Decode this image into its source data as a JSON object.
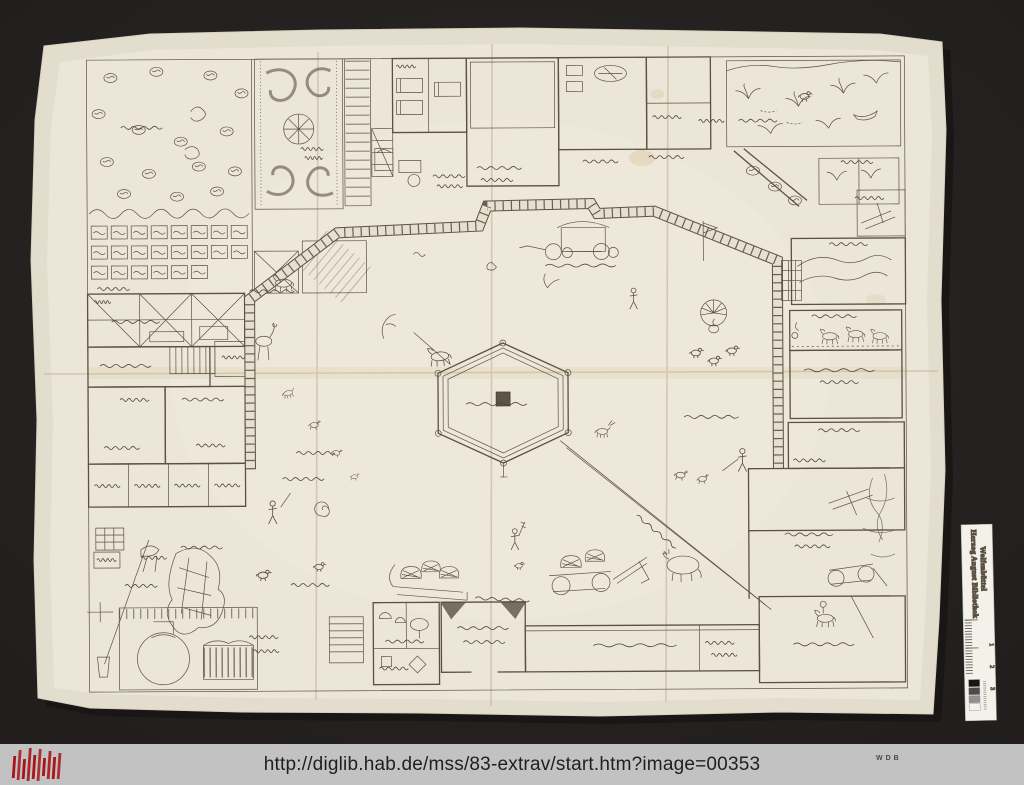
{
  "page": {
    "background_color": "#272424",
    "bottom_bar_color": "#c2c2c2"
  },
  "scan": {
    "paper_color": "#ebe6d8",
    "ink_color": "#5b5142",
    "stain_color": "#d9c7a0"
  },
  "color_ruler": {
    "institution_line1": "Herzog August Bibliothek",
    "institution_line2": "Wolfenbüttel",
    "tick_numbers": [
      "1",
      "2",
      "3"
    ],
    "grayscale_shades": [
      "#161616",
      "#4c4c4c",
      "#909090",
      "#f2f2ef"
    ]
  },
  "citation_bar": {
    "url": "http://diglib.hab.de/mss/83-extrav/start.htm?image=00353",
    "wdb_label": "WDB",
    "logo_color": "#a81419"
  }
}
